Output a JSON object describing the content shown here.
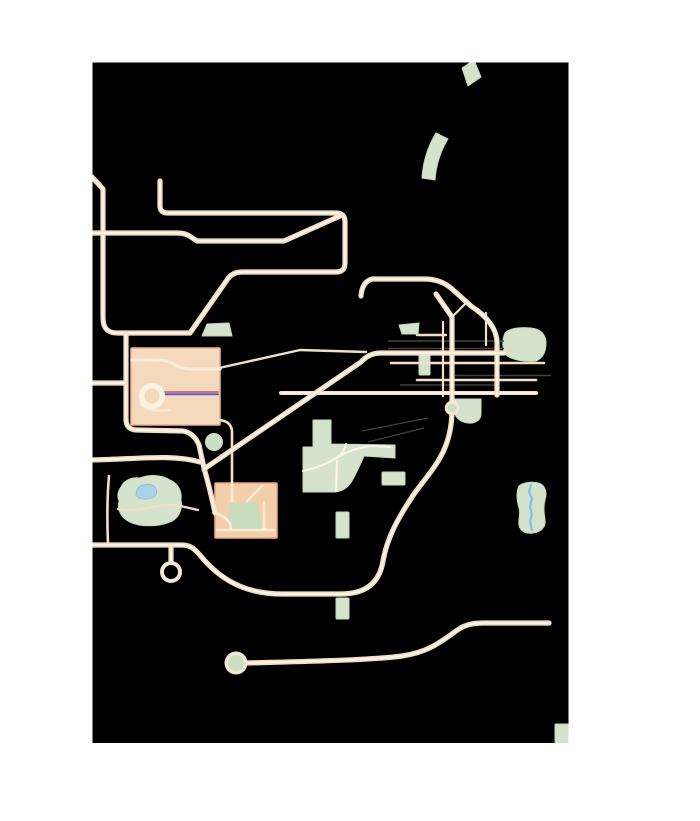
{
  "map": {
    "width": 700,
    "height": 821,
    "bounds": {
      "x": 92.5,
      "y": 62.5,
      "w": 476,
      "h": 680.5
    },
    "palette": {
      "page_bg": "#ffffff",
      "map_bg": "#000000",
      "road": "#f3dfc5",
      "road_core": "#fcf6ec",
      "road_internal": "#f8ecd6",
      "rail": "#46403a",
      "park": "#d5e3cd",
      "park_stroke": "#c7d8bd",
      "court_green": "#c8dbbd",
      "building1_fill": "#f5d9bc",
      "building1_stroke": "#eeae96",
      "building2_fill": "#f3cfa9",
      "building2_stroke": "#e7a98b",
      "water_fill": "#a9d3e8",
      "water_stroke": "#8fc0dc",
      "river": "#7fc3ea",
      "metro_red": "#d95f6d",
      "metro_blue": "#5063c8",
      "ring": "#f5e7d3",
      "ring_hole_dark": "#000000",
      "ring_hole_green": "#ccdfc5"
    },
    "buildings": [
      {
        "name": "stadium-block",
        "type": "rect",
        "x": 131,
        "y": 348,
        "w": 89,
        "h": 77,
        "fill": "@building1_fill",
        "stroke": "@building1_stroke",
        "width": 1.6
      },
      {
        "name": "plaza-block",
        "type": "rect",
        "x": 215,
        "y": 483,
        "w": 62,
        "h": 55,
        "fill": "@building2_fill",
        "stroke": "@building2_stroke",
        "width": 1.6
      }
    ],
    "greens": [
      {
        "name": "park-rotated-rect-north",
        "type": "path",
        "d": "M 462,68 L 474,60 L 481,77 L 468,86 Z",
        "fill": "@park",
        "stroke": "@park_stroke",
        "width": 1
      },
      {
        "name": "park-curved-band-north",
        "type": "path",
        "d": "M 436,133 C 428,146 423,162 422,178 L 435,180 C 436,165 441,150 448,139 Z",
        "fill": "@park",
        "stroke": "@park_stroke",
        "width": 1
      },
      {
        "name": "park-small-quad-junction",
        "type": "path",
        "d": "M 399,325 L 419,323 L 418,334 L 402,334 Z",
        "fill": "@park",
        "stroke": "@park_stroke",
        "width": 1
      },
      {
        "name": "park-vertical-strip-junction",
        "type": "rect",
        "x": 419,
        "y": 351,
        "w": 11,
        "h": 24,
        "fill": "@park",
        "stroke": "@park_stroke",
        "width": 1
      },
      {
        "name": "park-blob-east",
        "type": "path",
        "d": "M 505,333 C 510,328 520,327 531,328 C 541,329 546,335 546,343 C 546,352 543,358 536,361 C 524,362 512,360 506,355 C 502,350 502,340 505,333 Z",
        "fill": "@park",
        "stroke": "@park_stroke",
        "width": 1
      },
      {
        "name": "park-small-blob-below-junction",
        "type": "path",
        "d": "M 454,399 L 481,399 L 481,414 C 481,420 475,424 468,423 C 459,422 454,416 454,409 Z",
        "fill": "@park",
        "stroke": "@park_stroke",
        "width": 1
      },
      {
        "name": "park-central",
        "type": "path",
        "d": "M 313,420 L 331,420 L 331,444 L 395,445 L 395,458 L 364,456 Q 358,470 352,481 Q 346,491 335,492 L 303,492 L 303,447 L 313,447 Z",
        "fill": "@park",
        "stroke": "@park_stroke",
        "width": 1
      },
      {
        "name": "park-small-rect-east",
        "type": "rect",
        "x": 382,
        "y": 472,
        "w": 23,
        "h": 13,
        "fill": "@park",
        "stroke": "@park_stroke",
        "width": 1
      },
      {
        "name": "park-strip-below-central",
        "type": "rect",
        "x": 336,
        "y": 512,
        "w": 13,
        "h": 26,
        "fill": "@park",
        "stroke": "@park_stroke",
        "width": 1
      },
      {
        "name": "park-west-with-lake",
        "type": "path",
        "d": "M 121,487 C 124,480 132,477 140,478 C 150,474 162,475 170,480 C 179,484 182,492 181,500 C 183,510 178,519 170,522 C 158,527 140,527 130,522 C 121,518 117,510 119,501 C 117,496 118,491 121,487 Z",
        "fill": "@park",
        "stroke": "@park_stroke",
        "width": 1
      },
      {
        "name": "park-trapezoid-northwest",
        "type": "path",
        "d": "M 207,324 L 229,323 L 232,336 L 202,336 Z",
        "fill": "@park",
        "stroke": "@park_stroke",
        "width": 1
      },
      {
        "name": "park-riverside-east",
        "type": "path",
        "d": "M 519,486 C 523,482 535,481 541,484 C 546,487 547,494 545,500 C 543,507 544,514 545,520 C 546,527 541,532 533,533 C 526,534 520,531 519,525 C 518,519 521,514 519,508 C 517,501 516,492 519,486 Z",
        "fill": "@park",
        "stroke": "@park_stroke",
        "width": 1
      },
      {
        "name": "park-small-rect-south",
        "type": "rect",
        "x": 336,
        "y": 598,
        "w": 13,
        "h": 21,
        "fill": "@park",
        "stroke": "@park_stroke",
        "width": 1
      },
      {
        "name": "park-corner-southeast",
        "type": "rect",
        "x": 555,
        "y": 724,
        "w": 16,
        "h": 20,
        "fill": "@park",
        "stroke": "@park_stroke",
        "width": 1
      },
      {
        "name": "court-green-plaza",
        "type": "path",
        "d": "M 229,503 L 257,502 L 263,529 L 228,529 Z",
        "fill": "@court_green",
        "stroke": "none",
        "width": 0
      }
    ],
    "water": [
      {
        "name": "lake-west-park",
        "type": "path",
        "d": "M 137,489 C 141,484 150,483 155,487 C 158,491 157,496 152,498 C 145,500 138,499 136,495 Z",
        "fill": "@water_fill",
        "stroke": "@water_stroke",
        "width": 1
      },
      {
        "name": "river-east-park",
        "type": "path",
        "d": "M 531,485 L 529,492 L 532,499 L 530,507 L 532,514 L 530,521 L 532,530",
        "fill": "none",
        "stroke": "@river",
        "width": 2.2
      }
    ],
    "rails": [
      {
        "name": "rail-line-1",
        "type": "path",
        "d": "M 388,341 L 504,341",
        "stroke": "@rail",
        "width": 1.4
      },
      {
        "name": "rail-line-2",
        "type": "path",
        "d": "M 388,348.5 L 504,348.5",
        "stroke": "@rail",
        "width": 1.4
      },
      {
        "name": "rail-line-3",
        "type": "path",
        "d": "M 455,375.5 L 551,375.5",
        "stroke": "@rail",
        "width": 1.4
      },
      {
        "name": "rail-line-4",
        "type": "path",
        "d": "M 400,385 L 499,385",
        "stroke": "@rail",
        "width": 1.4
      },
      {
        "name": "rail-spur-1",
        "type": "path",
        "d": "M 428,418 L 362,431",
        "stroke": "@rail",
        "width": 1.3
      },
      {
        "name": "rail-spur-2",
        "type": "path",
        "d": "M 424,428 L 368,442",
        "stroke": "@rail",
        "width": 1.3
      }
    ],
    "roads_minor": [
      {
        "name": "road-vertical-x443",
        "type": "path",
        "d": "M 443,322 L 443,396",
        "width": 2.2
      },
      {
        "name": "road-vertical-x486",
        "type": "path",
        "d": "M 486,313 L 486,345",
        "width": 2.2
      },
      {
        "name": "road-chevron-east-arm",
        "type": "path",
        "d": "M 452,317 L 466,303",
        "width": 2.2
      },
      {
        "name": "road-stadium-east-diagonal",
        "type": "path",
        "d": "M 219,368 L 300,350 L 366,352",
        "width": 2.4
      },
      {
        "name": "road-y335-short",
        "type": "path",
        "d": "M 417,335 L 446,335",
        "width": 2.4
      },
      {
        "name": "road-y363",
        "type": "path",
        "d": "M 391,363 L 544,363",
        "width": 2.6
      },
      {
        "name": "road-y380",
        "type": "path",
        "d": "M 417,380 L 536,380",
        "width": 2.6
      },
      {
        "name": "road-plaza-connector-x232",
        "type": "path",
        "d": "M 219,420 Q 231,421 232,431 L 232,482",
        "width": 2.6
      },
      {
        "name": "road-vertical-x109",
        "type": "path",
        "d": "M 109,476 C 107,498 107,520 108,544",
        "width": 2.6
      },
      {
        "name": "road-through-west-park",
        "type": "path",
        "d": "M 118,509 C 138,514 156,503 176,505 L 198,510",
        "width": 2.2
      }
    ],
    "roads_mid": [
      {
        "name": "road-y393",
        "type": "path",
        "d": "M 281,393 L 536,393",
        "width": 4
      }
    ],
    "roads_major": [
      {
        "name": "road-west-edge-vertical",
        "type": "path",
        "d": "M 92,177 L 103,189 L 103,318 Q 103,333 117,333 L 190,333"
      },
      {
        "name": "road-northwest-loop",
        "type": "path",
        "d": "M 160,181 L 160,206 Q 160,213 168,213 L 336,213 Q 345,213 345,222 L 345,263 Q 345,272 336,272 L 242,272 Q 232,272 227,280 L 190,333"
      },
      {
        "name": "road-west-y233",
        "type": "path",
        "d": "M 90,233 L 177,233 Q 186,233 191,237 L 197,241 L 284,241 L 340,216"
      },
      {
        "name": "road-junction-main-curve",
        "type": "path",
        "d": "M 361,296 Q 362,282 372,279 L 424,279 Q 441,279 452,289 L 471,306 Q 497,323 497,343 L 497,395"
      },
      {
        "name": "road-sweep-south",
        "type": "path",
        "d": "M 436,294 L 452,317 L 452,412 C 451,452 433,468 414,494 C 396,521 387,539 383,561 C 379,586 362,594 341,594 L 283,594 C 252,594 227,585 205,561 C 197,552 193,545 182,545 L 90,545"
      },
      {
        "name": "road-south-long",
        "type": "path",
        "d": "M 247,663 C 320,661 372,660 402,656 C 431,652 444,639 459,629 Q 468,623 483,623 L 549,623"
      },
      {
        "name": "road-x126-s-curve",
        "type": "path",
        "d": "M 126,334 L 126,419 Q 126,430 137,430 L 183,431 Q 194,433 199,445 L 204,468 Q 211,493 215,513"
      },
      {
        "name": "road-diagonal-a",
        "type": "path",
        "d": "M 204,469 L 361,362 Q 369,353 381,353 L 504,353"
      },
      {
        "name": "road-west-y459",
        "type": "path",
        "d": "M 90,460 C 140,459 172,454 200,462"
      },
      {
        "name": "road-west-y383",
        "type": "path",
        "d": "M 90,383 L 125,383"
      },
      {
        "name": "road-stub-x171",
        "type": "path",
        "d": "M 171,545 L 171,562"
      }
    ],
    "roads_internal": [
      {
        "name": "stadium-cross-road",
        "type": "path",
        "d": "M 132,360 L 157,360 Q 169,360 175,365 Q 181,369 193,369 L 220,369",
        "width": 3.2
      },
      {
        "name": "stadium-ring-tail",
        "type": "path",
        "d": "M 140,404 Q 151,413 170,410",
        "width": 2.2
      },
      {
        "name": "plaza-road-top",
        "type": "path",
        "d": "M 232,483 L 232,501",
        "width": 2.6
      },
      {
        "name": "plaza-road-diagonal",
        "type": "path",
        "d": "M 262,486 L 247,501",
        "width": 2.6
      },
      {
        "name": "plaza-road-bottom",
        "type": "path",
        "d": "M 217,530 L 274,530",
        "width": 2.6
      },
      {
        "name": "plaza-road-right",
        "type": "path",
        "d": "M 264,502 L 264,530",
        "width": 2.6
      },
      {
        "name": "plaza-road-gate",
        "type": "path",
        "d": "M 215,513 Q 227,517 230,524 L 231,530",
        "width": 2.6
      }
    ],
    "park_paths": [
      {
        "name": "central-park-path-west",
        "type": "path",
        "d": "M 303,471 C 318,468 328,463 336,458 C 343,453 345,449 346,444",
        "width": 2
      },
      {
        "name": "central-park-path-east",
        "type": "path",
        "d": "M 336,458 C 348,451 360,447 372,446 L 390,447",
        "width": 2
      },
      {
        "name": "central-park-path-south",
        "type": "path",
        "d": "M 337,461 L 336,491",
        "width": 2
      }
    ],
    "metro_lines": [
      {
        "name": "metro-blue-line",
        "type": "path",
        "d": "M 162,394.2 L 218,394.2",
        "stroke": "@metro_blue",
        "width": 2
      },
      {
        "name": "metro-red-line",
        "type": "path",
        "d": "M 162,392 L 218,392",
        "stroke": "@metro_red",
        "width": 1.7
      }
    ],
    "circles": [
      {
        "name": "stadium-ring-outer",
        "cx": 152,
        "cy": 396,
        "r": 13,
        "fill": "#fdf3e3"
      },
      {
        "name": "stadium-ring-hole",
        "cx": 152,
        "cy": 396,
        "r": 7.5,
        "fill": "@building1_fill"
      },
      {
        "name": "green-disc-x214",
        "cx": 214,
        "cy": 442,
        "r": 9,
        "fill": "@ring_hole_green"
      },
      {
        "name": "ring-dark-x171-outer",
        "cx": 171,
        "cy": 572,
        "r": 11,
        "fill": "@ring"
      },
      {
        "name": "ring-dark-x171-hole",
        "cx": 171,
        "cy": 572,
        "r": 7,
        "fill": "@ring_hole_dark"
      },
      {
        "name": "ring-green-south-outer",
        "cx": 236,
        "cy": 663,
        "r": 11.5,
        "fill": "@ring"
      },
      {
        "name": "ring-green-south-hole",
        "cx": 236,
        "cy": 663,
        "r": 8,
        "fill": "@ring_hole_green"
      },
      {
        "name": "ring-green-junction-outer",
        "cx": 452,
        "cy": 408,
        "r": 7.2,
        "fill": "@ring"
      },
      {
        "name": "ring-green-junction-hole",
        "cx": 452,
        "cy": 408,
        "r": 4.4,
        "fill": "@ring_hole_green"
      }
    ]
  }
}
